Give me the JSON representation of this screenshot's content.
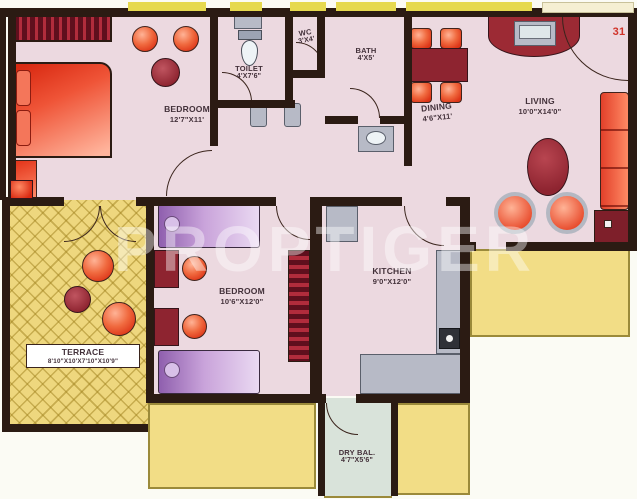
{
  "floor_plan": {
    "unit_number": "31",
    "watermark": "PROPTIGER",
    "rooms": {
      "bedroom1": {
        "name": "BEDROOM",
        "dims": "12'7\"X11'"
      },
      "toilet": {
        "name": "TOILET",
        "dims": "4'X7'6\""
      },
      "wc": {
        "name": "WC",
        "dims": "3'X4'"
      },
      "bath": {
        "name": "BATH",
        "dims": "4'X5'"
      },
      "dining": {
        "name": "DINING",
        "dims": "4'6\"X11'"
      },
      "living": {
        "name": "LIVING",
        "dims": "10'0\"X14'0\""
      },
      "bedroom2": {
        "name": "BEDROOM",
        "dims": "10'6\"X12'0\""
      },
      "kitchen": {
        "name": "KITCHEN",
        "dims": "9'0\"X12'0\""
      },
      "terrace": {
        "name": "TERRACE",
        "dims": "8'10\"X10'X7'10\"X10'9\""
      },
      "dry_balcony": {
        "name": "DRY BAL.",
        "dims": "4'7\"X5'6\""
      }
    },
    "colors": {
      "wall": "#2b1b13",
      "room_floor": "#ecd9e0",
      "terrace_yellow": "#eed77e",
      "balcony_yellow": "#f2dd86",
      "dry_balcony_floor": "#d9e3da",
      "furniture_red": "#e2402a",
      "furniture_maroon": "#8e2430",
      "bed_purple": "#b487c6",
      "fixture_gray": "#b7bac6",
      "unit_number_red": "#d03228"
    }
  }
}
